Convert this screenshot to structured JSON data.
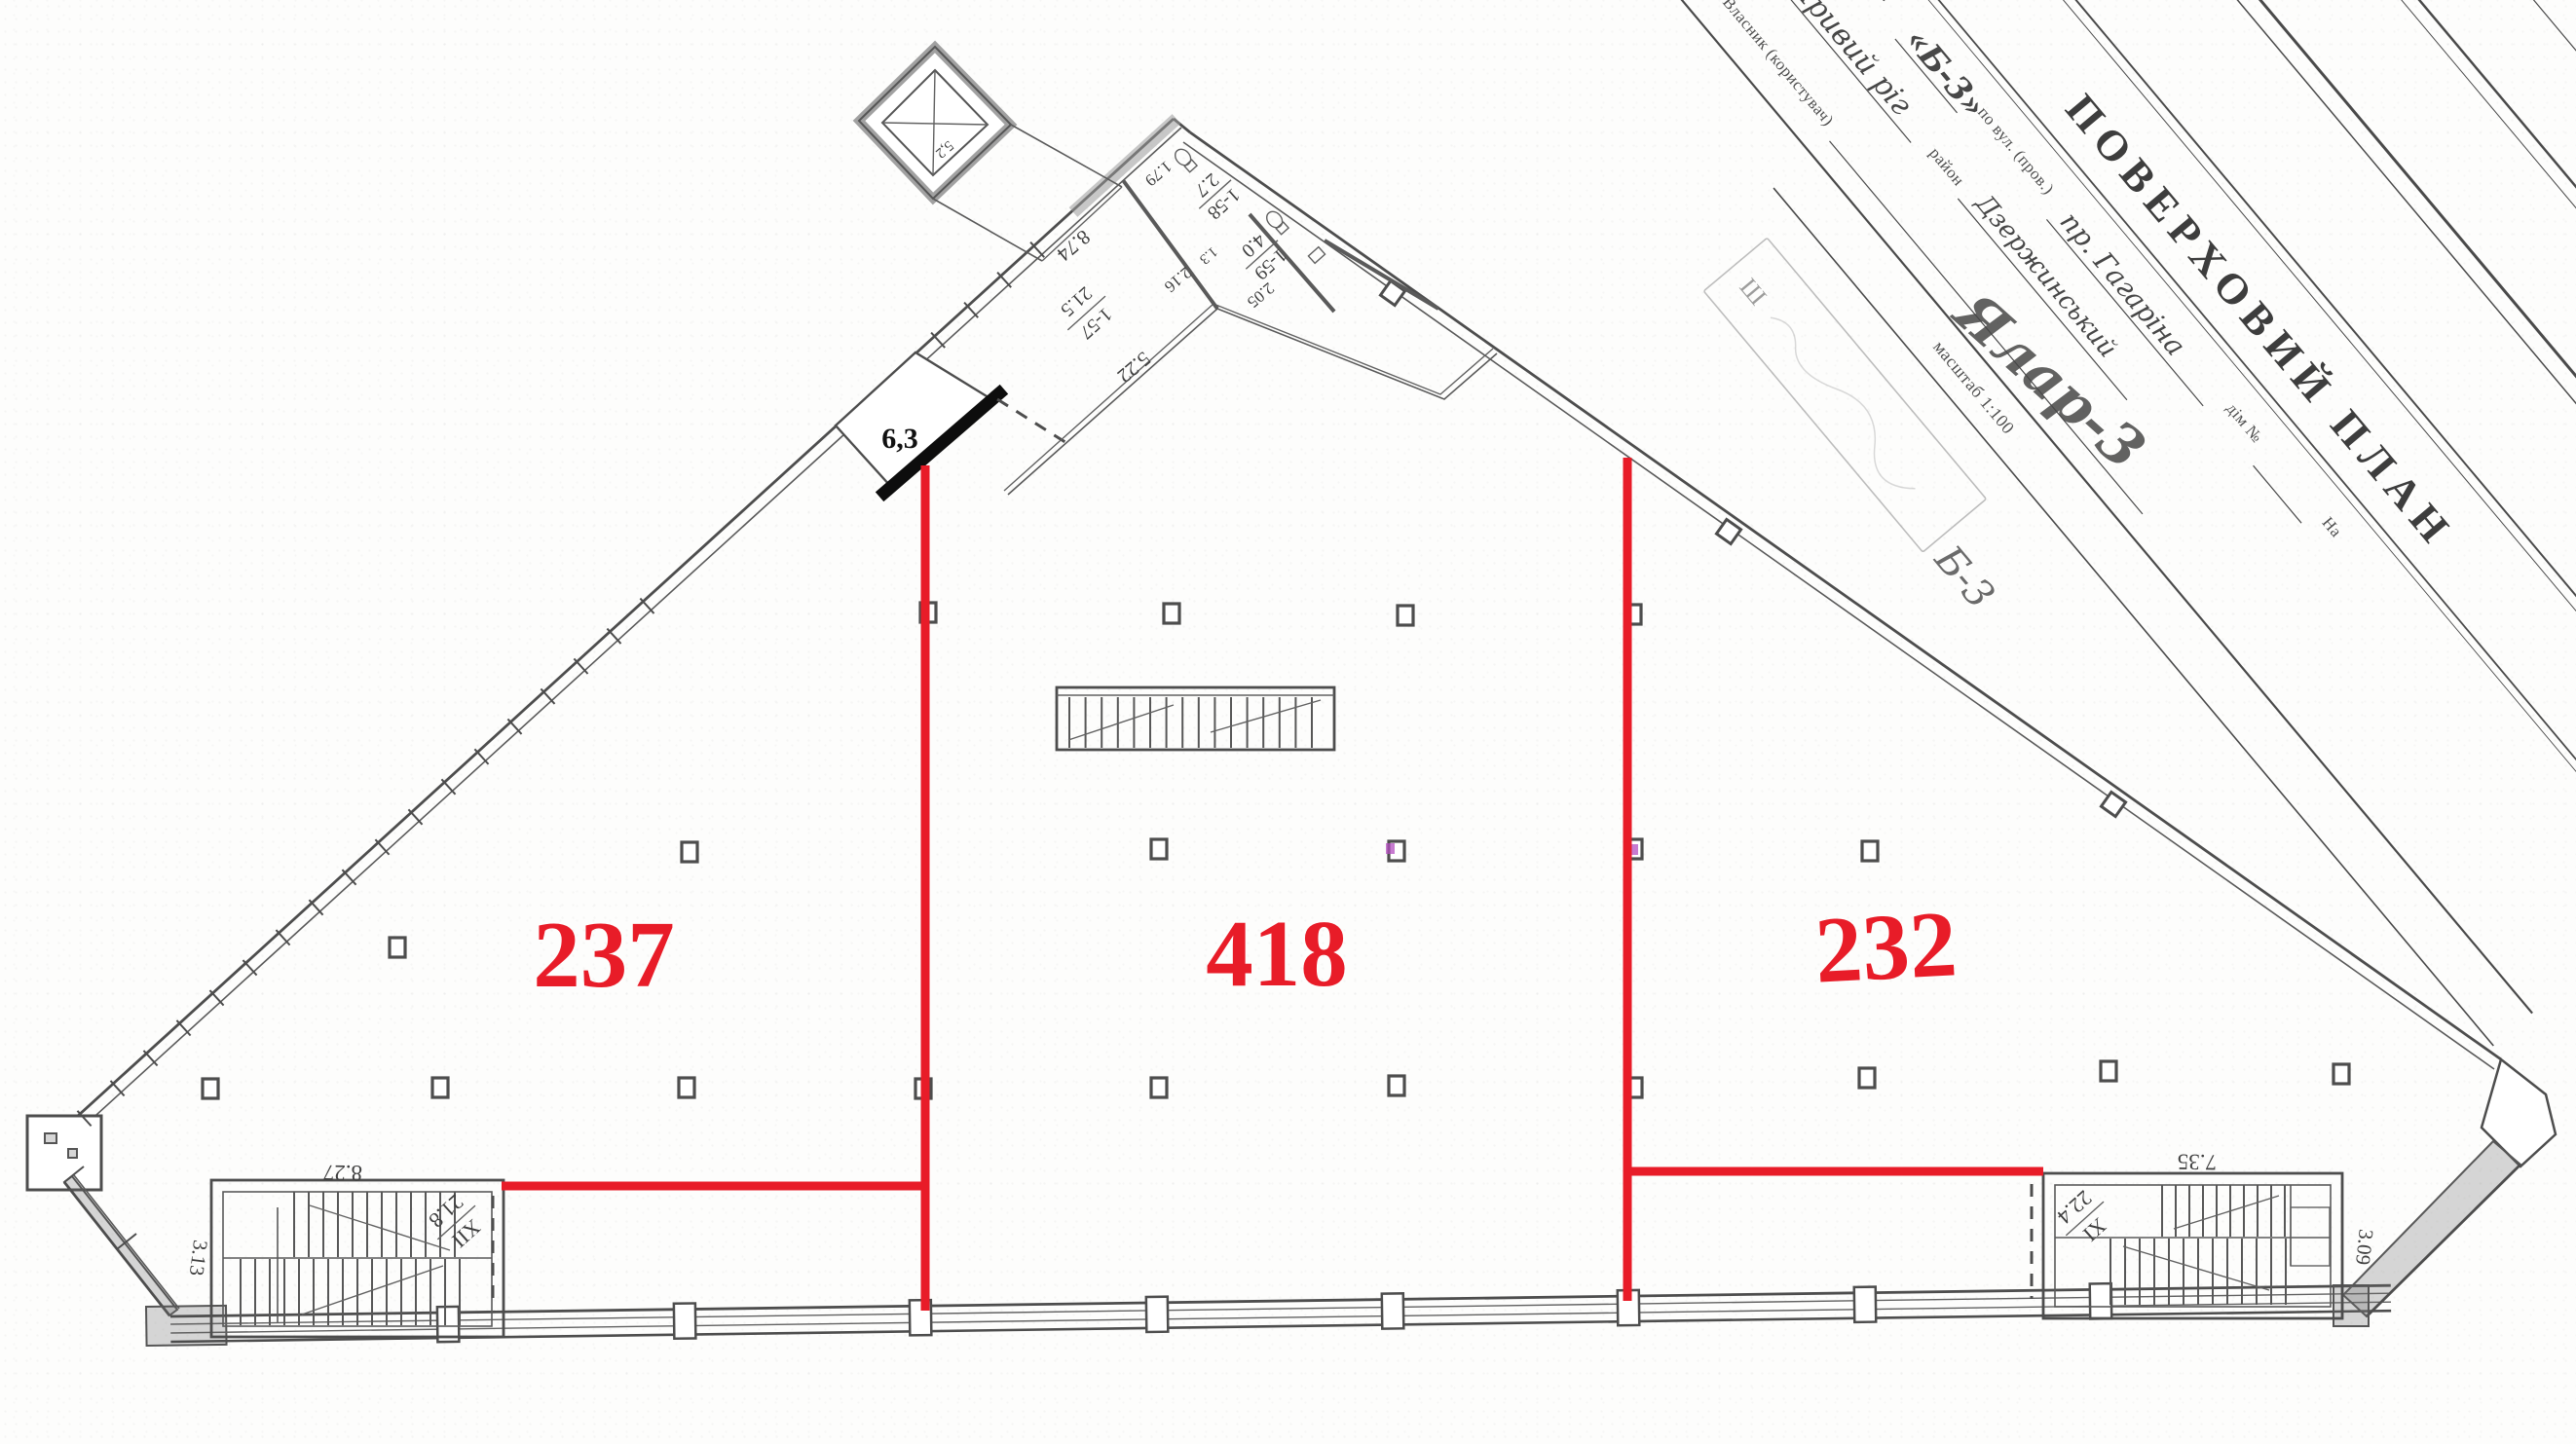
{
  "title_block": {
    "sheet_title": "ПОВЕРХОВИЙ ПЛАН",
    "building_label": "будинку літ.",
    "building_value": "«Б-3»",
    "street_label": "по вул. (пров.)",
    "street_value": "пр. Гагаріна",
    "house_label": "дім №",
    "house_suffix": "На",
    "city_value": "Кривий ріг",
    "district_label": "район",
    "district_value": "Дзержинський",
    "owner_label": "Власник (користувач)",
    "owner_signature": "Ялар-3",
    "scale_label": "масштаб 1:100",
    "stamp_mark": "Ш",
    "stamp_note": "Б-3"
  },
  "plan": {
    "zones": {
      "left": "237",
      "center": "418",
      "right": "232"
    },
    "room63_area": "6,3",
    "elevator_area": "5,2",
    "rooms": {
      "r157": {
        "id": "1-57",
        "area": "21.5"
      },
      "r158": {
        "id": "1-58",
        "area": "2.7"
      },
      "r159": {
        "id": "1-59",
        "area": "4.0"
      }
    },
    "dims": {
      "corridor": "8.74",
      "edge": "5.22",
      "w158": "1.79",
      "part": "2.16",
      "fix": "1.3",
      "w159": "2.05"
    },
    "stairs_left": {
      "num": "XII",
      "area": "21.8",
      "width": "8.27",
      "depth": "3.13"
    },
    "stairs_right": {
      "num": "XI",
      "area": "22.4",
      "width": "7.35",
      "depth": "3.09"
    }
  },
  "colors": {
    "accent_red": "#e81c28",
    "ink": "#4d4d4d"
  }
}
